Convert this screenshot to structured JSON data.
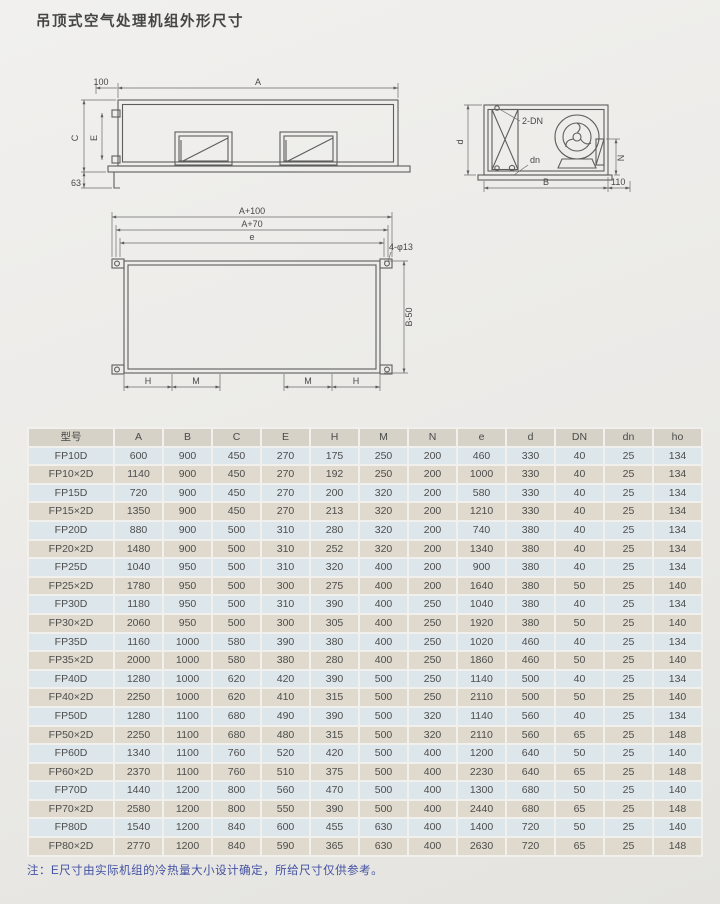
{
  "page": {
    "title": "吊顶式空气处理机组外形尺寸",
    "note": "注：E尺寸由实际机组的冷热量大小设计确定，所给尺寸仅供参考。"
  },
  "colors": {
    "note_text": "#4352a2",
    "header_bg": "#d6d2c7",
    "row_cool": "#dde6ea",
    "row_warm": "#dfdacd",
    "line": "#5d5d5d"
  },
  "drawings": {
    "front": {
      "a": "A",
      "n100": "100",
      "c": "C",
      "e": "E",
      "n63": "63"
    },
    "side": {
      "dn2": "2-DN",
      "d": "d",
      "dn": "dn",
      "n": "N",
      "b": "B",
      "n110": "110"
    },
    "plan": {
      "a100": "A+100",
      "a70": "A+70",
      "e": "e",
      "holes": "4-φ13",
      "b50": "B-50",
      "h": "H",
      "m": "M"
    }
  },
  "table": {
    "headers": [
      "型号",
      "A",
      "B",
      "C",
      "E",
      "H",
      "M",
      "N",
      "e",
      "d",
      "DN",
      "dn",
      "ho"
    ],
    "rows": [
      [
        "FP10D",
        600,
        900,
        450,
        270,
        175,
        250,
        200,
        460,
        330,
        40,
        25,
        134
      ],
      [
        "FP10×2D",
        1140,
        900,
        450,
        270,
        192,
        250,
        200,
        1000,
        330,
        40,
        25,
        134
      ],
      [
        "FP15D",
        720,
        900,
        450,
        270,
        200,
        320,
        200,
        580,
        330,
        40,
        25,
        134
      ],
      [
        "FP15×2D",
        1350,
        900,
        450,
        270,
        213,
        320,
        200,
        1210,
        330,
        40,
        25,
        134
      ],
      [
        "FP20D",
        880,
        900,
        500,
        310,
        280,
        320,
        200,
        740,
        380,
        40,
        25,
        134
      ],
      [
        "FP20×2D",
        1480,
        900,
        500,
        310,
        252,
        320,
        200,
        1340,
        380,
        40,
        25,
        134
      ],
      [
        "FP25D",
        1040,
        950,
        500,
        310,
        320,
        400,
        200,
        900,
        380,
        40,
        25,
        134
      ],
      [
        "FP25×2D",
        1780,
        950,
        500,
        300,
        275,
        400,
        200,
        1640,
        380,
        50,
        25,
        140
      ],
      [
        "FP30D",
        1180,
        950,
        500,
        310,
        390,
        400,
        250,
        1040,
        380,
        40,
        25,
        134
      ],
      [
        "FP30×2D",
        2060,
        950,
        500,
        300,
        305,
        400,
        250,
        1920,
        380,
        50,
        25,
        140
      ],
      [
        "FP35D",
        1160,
        1000,
        580,
        390,
        380,
        400,
        250,
        1020,
        460,
        40,
        25,
        134
      ],
      [
        "FP35×2D",
        2000,
        1000,
        580,
        380,
        280,
        400,
        250,
        1860,
        460,
        50,
        25,
        140
      ],
      [
        "FP40D",
        1280,
        1000,
        620,
        420,
        390,
        500,
        250,
        1140,
        500,
        40,
        25,
        134
      ],
      [
        "FP40×2D",
        2250,
        1000,
        620,
        410,
        315,
        500,
        250,
        2110,
        500,
        50,
        25,
        140
      ],
      [
        "FP50D",
        1280,
        1100,
        680,
        490,
        390,
        500,
        320,
        1140,
        560,
        40,
        25,
        134
      ],
      [
        "FP50×2D",
        2250,
        1100,
        680,
        480,
        315,
        500,
        320,
        2110,
        560,
        65,
        25,
        148
      ],
      [
        "FP60D",
        1340,
        1100,
        760,
        520,
        420,
        500,
        400,
        1200,
        640,
        50,
        25,
        140
      ],
      [
        "FP60×2D",
        2370,
        1100,
        760,
        510,
        375,
        500,
        400,
        2230,
        640,
        65,
        25,
        148
      ],
      [
        "FP70D",
        1440,
        1200,
        800,
        560,
        470,
        500,
        400,
        1300,
        680,
        50,
        25,
        140
      ],
      [
        "FP70×2D",
        2580,
        1200,
        800,
        550,
        390,
        500,
        400,
        2440,
        680,
        65,
        25,
        148
      ],
      [
        "FP80D",
        1540,
        1200,
        840,
        600,
        455,
        630,
        400,
        1400,
        720,
        50,
        25,
        140
      ],
      [
        "FP80×2D",
        2770,
        1200,
        840,
        590,
        365,
        630,
        400,
        2630,
        720,
        65,
        25,
        148
      ]
    ]
  }
}
